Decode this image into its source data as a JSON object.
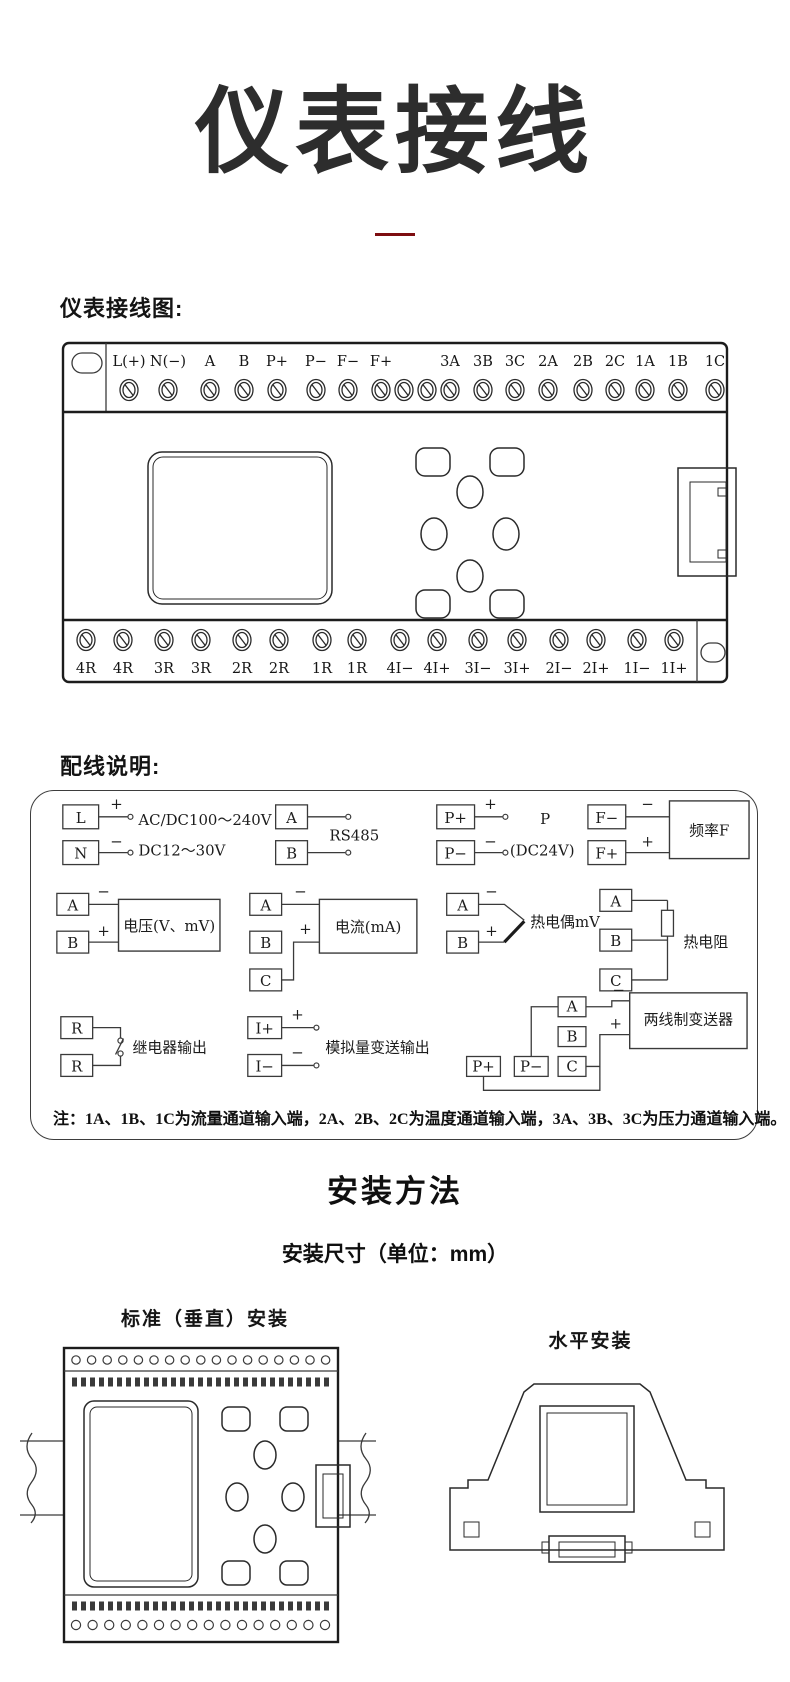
{
  "title": "仪表接线",
  "section1": {
    "label": "仪表接线图:"
  },
  "section2": {
    "label": "配线说明:"
  },
  "sym": {
    "plus": "+",
    "minus": "−"
  },
  "device": {
    "top_terminals": [
      "L(+)",
      "N(−)",
      "A",
      "B",
      "P+",
      "P−",
      "F−",
      "F+",
      "3A",
      "3B",
      "3C",
      "2A",
      "2B",
      "2C",
      "1A",
      "1B",
      "1C"
    ],
    "bottom_terminals": [
      "4R",
      "4R",
      "3R",
      "3R",
      "2R",
      "2R",
      "1R",
      "1R",
      "4I−",
      "4I+",
      "3I−",
      "3I+",
      "2I−",
      "2I+",
      "1I−",
      "1I+"
    ]
  },
  "groups": {
    "power": {
      "t1": "L",
      "t2": "N",
      "line1": "AC/DC100～240V",
      "line2": "DC12～30V"
    },
    "rs485": {
      "t1": "A",
      "t2": "B",
      "label": "RS485"
    },
    "p24": {
      "t1": "P+",
      "t2": "P−",
      "label1": "P",
      "label2": "(DC24V)"
    },
    "freq": {
      "t1": "F−",
      "t2": "F+",
      "label": "频率F"
    },
    "voltage": {
      "t1": "A",
      "t2": "B",
      "label": "电压(V、mV)"
    },
    "current": {
      "t1": "A",
      "t2": "B",
      "t3": "C",
      "label": "电流(mA)"
    },
    "tc": {
      "t1": "A",
      "t2": "B",
      "label": "热电偶mV"
    },
    "rtd": {
      "t1": "A",
      "t2": "B",
      "t3": "C",
      "label": "热电阻"
    },
    "relay": {
      "t1": "R",
      "t2": "R",
      "label": "继电器输出"
    },
    "aout": {
      "t1": "I+",
      "t2": "I−",
      "label": "模拟量变送输出"
    },
    "tx": {
      "t1": "A",
      "t2": "B",
      "t3": "C",
      "t4": "P+",
      "t5": "P−",
      "label": "两线制变送器"
    }
  },
  "note": "注：1A、1B、1C为流量通道输入端，2A、2B、2C为温度通道输入端，3A、3B、3C为压力通道输入端。",
  "install": {
    "title": "安装方法",
    "subtitle": "安装尺寸（单位：mm）",
    "vertical_label": "标准（垂直）安装",
    "horizontal_label": "水平安装"
  },
  "colors": {
    "accent": "#7d0d10",
    "ink": "#1a1a1a"
  }
}
